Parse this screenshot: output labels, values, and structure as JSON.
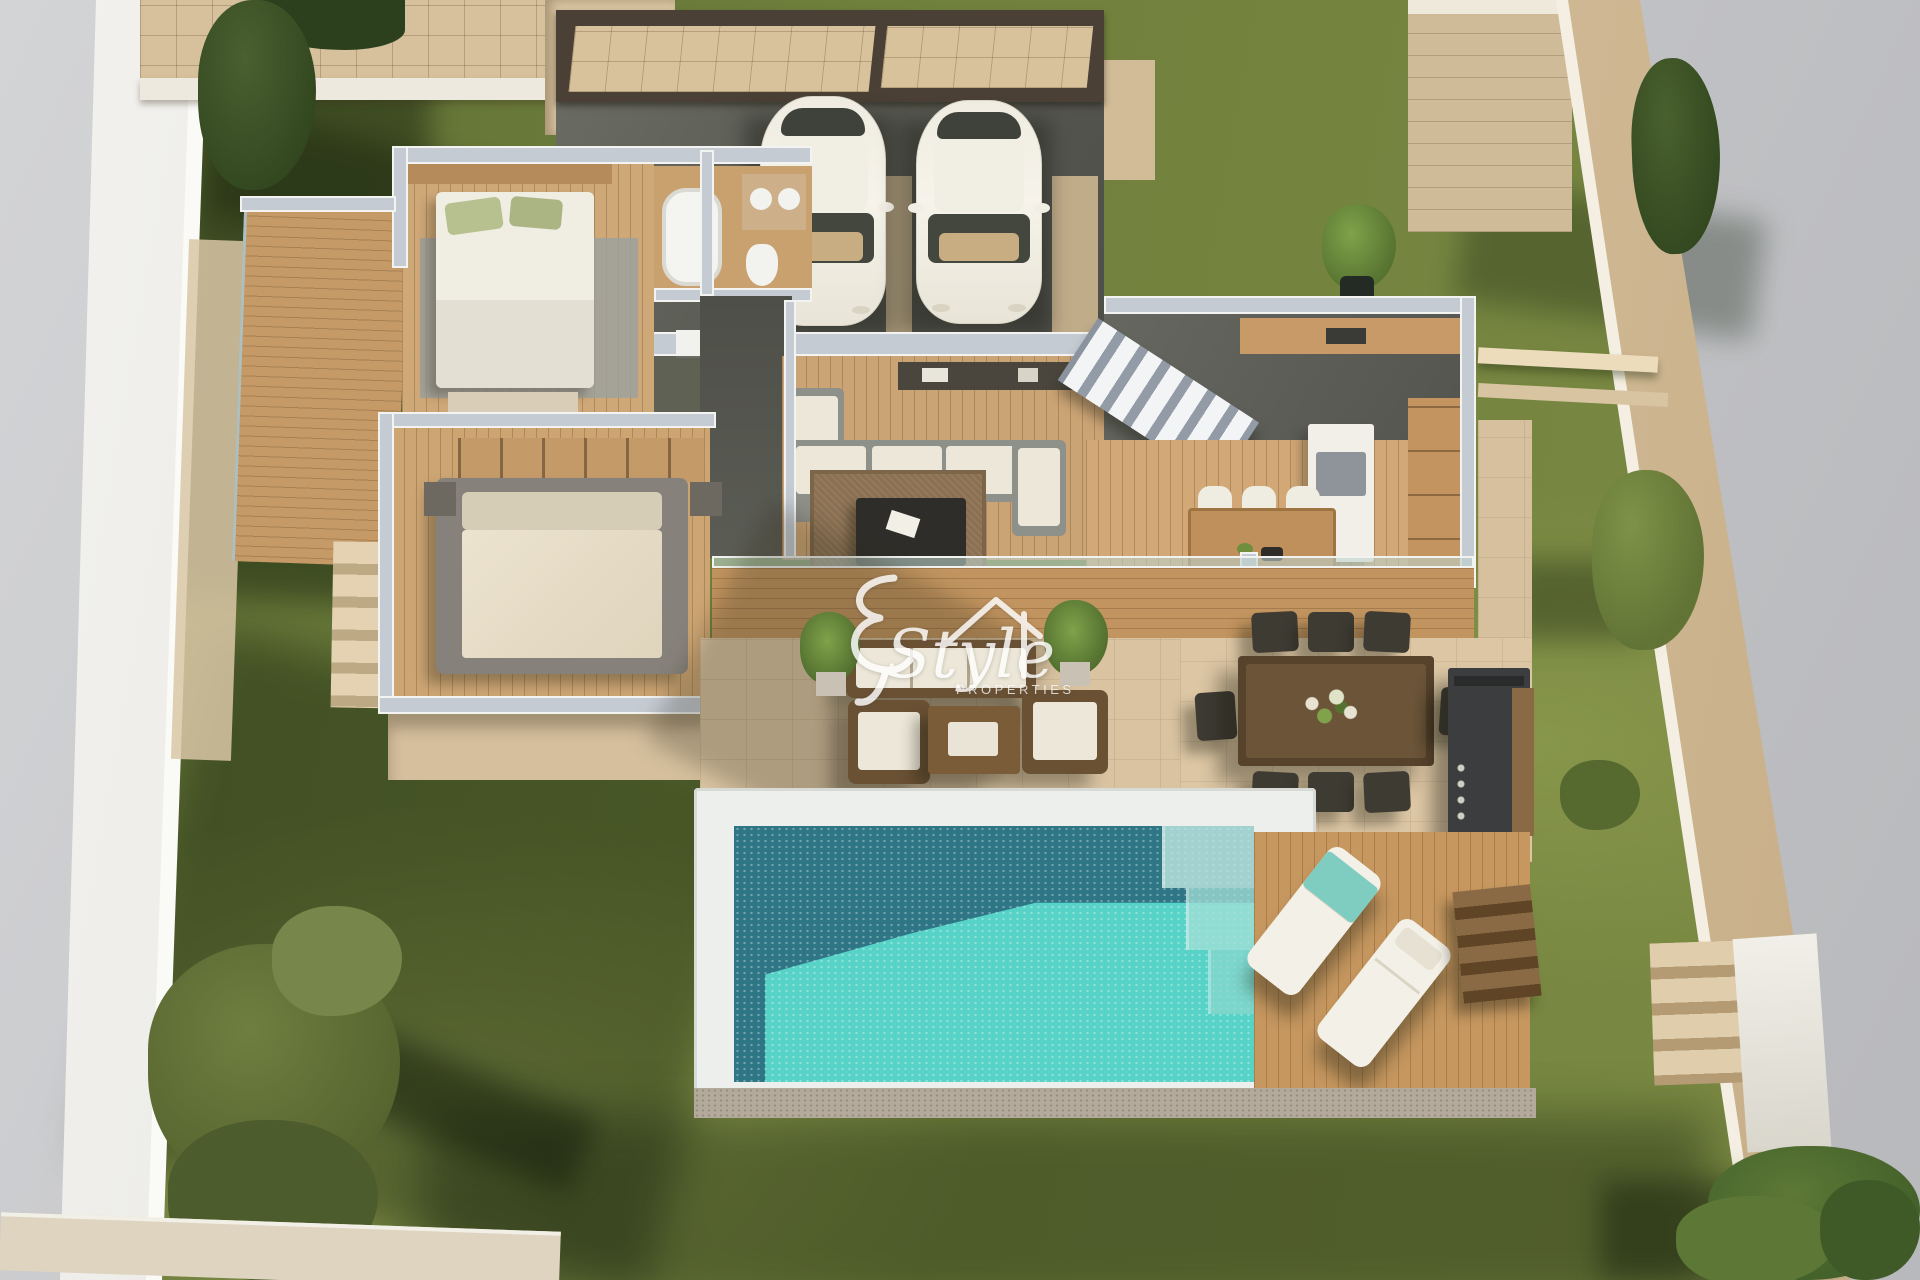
{
  "watermark": {
    "script": "Style",
    "subtitle": "PROPERTIES"
  },
  "scene": {
    "type": "3d-floor-plan-render",
    "view": "aerial-top-down",
    "subject": "detached villa ground floor with garden and private pool",
    "features": [
      "carport with two parked cars",
      "bedroom with ensuite bathroom",
      "master bedroom with wardrobe",
      "living room with corner sofa",
      "staircase",
      "kitchen island",
      "indoor dining table",
      "outdoor lounge set",
      "outdoor dining table for eight",
      "outdoor kitchen barbecue",
      "rectangular swimming pool",
      "wooden sun deck",
      "two sun loungers",
      "lawn garden",
      "boundary walls",
      "cypress and garden trees"
    ]
  },
  "palette": {
    "bg": "#c6c7c9",
    "lawn": "#71813d",
    "lawn_dark": "#4b5b2b",
    "lawn_light": "#9aa355",
    "stone": "#d9c3a1",
    "stone_light": "#e4d2b2",
    "wood": "#c2945f",
    "wood_floor": "#cfa878",
    "wall_white": "#f2f1ec",
    "wall_top": "#c5cbd3",
    "pave": "#5e5f57",
    "roof_dark": "#4a4035",
    "tile": "#d8c29c",
    "pool_dark": "#2e7585",
    "pool_bright": "#57d2c7",
    "car": "#f3f0e7",
    "sofa": "#8e908a",
    "cushion": "#ece7d8",
    "brown": "#6a5134",
    "brown_dark": "#3e3b33",
    "towel": "#7fccc0",
    "hedge": "#2c401e",
    "tree": "#4d672c",
    "rug": "#8b7052",
    "glass": "#bcd2cc",
    "gravel": "#b3aa9b"
  }
}
